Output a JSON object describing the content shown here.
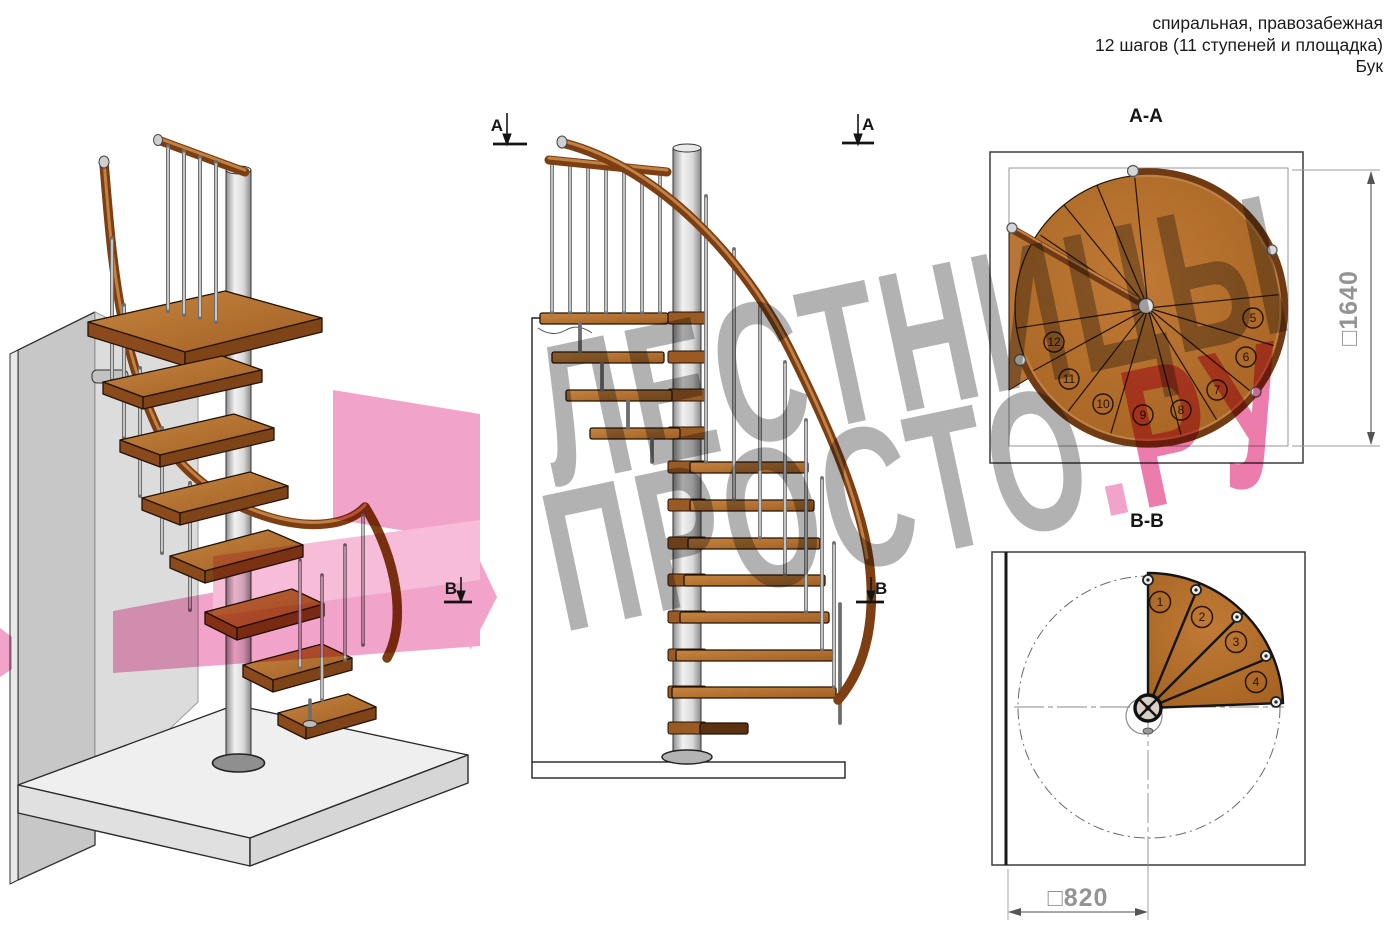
{
  "header": {
    "line1": "спиральная, правозабежная",
    "line2": "12 шагов (11 ступеней и площадка)",
    "line3": "Бук"
  },
  "watermark": {
    "line1": "ЛЕСТНИЦЫ",
    "line2_gray": "ПРОСТО",
    "line2_dot": ".",
    "line2_pink": "РУ"
  },
  "section_markers": {
    "a": "А",
    "b": "В"
  },
  "plan_aa": {
    "title": "А-А",
    "dimension_label": "□1640",
    "step_numbers": [
      "5",
      "6",
      "7",
      "8",
      "9",
      "10",
      "11",
      "12"
    ]
  },
  "plan_bb": {
    "title": "В-В",
    "dimension_label": "□820",
    "step_numbers": [
      "1",
      "2",
      "3",
      "4"
    ]
  },
  "colors": {
    "watermark-gray": "#b2b2b2",
    "watermark-pink": "#ec7cab",
    "watermark-pink-light": "#f2a3c9",
    "wood": "#b4702e",
    "wood-light": "#c6853f",
    "wood-dark": "#7e4316",
    "rail": "#7c3e12",
    "rail-highlight": "#c08145",
    "outline": "#241306",
    "metal": "#c9c9c9",
    "wall": "#c7c7c7",
    "wall-inner": "#dcdcdc",
    "floor": "#efefef",
    "dim-gray": "#949494",
    "line": "#1c1c1c"
  }
}
